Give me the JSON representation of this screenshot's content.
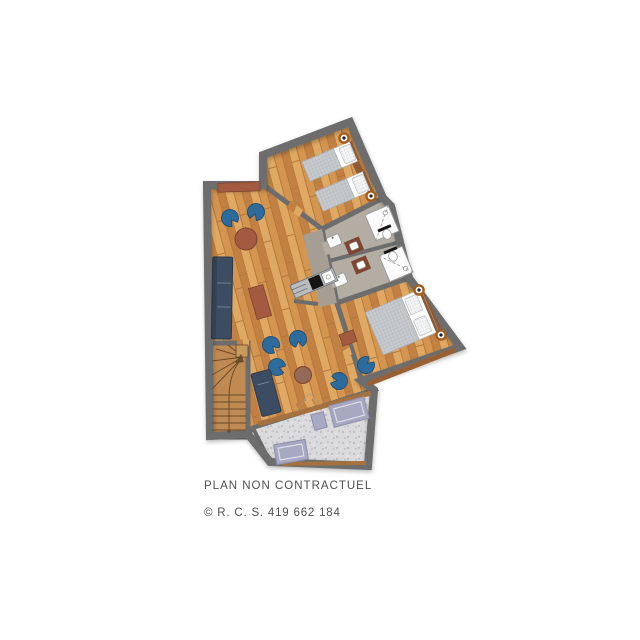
{
  "plan": {
    "caption": "PLAN NON CONTRACTUEL",
    "registration": "© R. C. S. 419 662 184"
  },
  "elements": {
    "rooms": [
      "living-dining-room",
      "twin-bedroom",
      "double-bedroom",
      "bathroom-1",
      "bathroom-2",
      "hallway",
      "kitchenette",
      "staircase",
      "terrace"
    ],
    "furniture": [
      {
        "name": "twin-bed",
        "count": 2
      },
      {
        "name": "double-bed",
        "count": 1
      },
      {
        "name": "wall-light",
        "count": 4
      },
      {
        "name": "shower",
        "count": 2
      },
      {
        "name": "toilet",
        "count": 2
      },
      {
        "name": "washbasin",
        "count": 2
      },
      {
        "name": "vanity-unit",
        "count": 2
      },
      {
        "name": "kitchen-unit",
        "count": 1
      },
      {
        "name": "sofa",
        "count": 1
      },
      {
        "name": "lounge-chair-blue",
        "count": 7
      },
      {
        "name": "chaise-longue",
        "count": 1
      },
      {
        "name": "round-table",
        "count": 2
      },
      {
        "name": "dining-table",
        "count": 1
      },
      {
        "name": "sideboard",
        "count": 1
      },
      {
        "name": "sun-lounger-mat",
        "count": 3
      },
      {
        "name": "winder-staircase",
        "count": 1
      }
    ]
  },
  "colors": {
    "background": "#ffffff",
    "wall": "#6d6d6d",
    "wood_light": "#e0a963",
    "wood_mid": "#d3954f",
    "wood_dark": "#c28143",
    "wood_line": "#b1753a",
    "tile": "#b4ada4",
    "tile_dark": "#a69e94",
    "white_fixture": "#fbfbfb",
    "fixture_line": "#9a9a9a",
    "bed_cover": "#c7cacd",
    "bed_grid": "#a6abb1",
    "pillow": "#f2f3f4",
    "headboard": "#8d5a35",
    "sill": "#9a6033",
    "terrace_floor": "#dadadc",
    "terrace_dot": "#9a9aa0",
    "terrace_band": "#a5713f",
    "mat": "#a7a8c2",
    "mat_line": "#8e8fad",
    "navy": "#3c4d63",
    "navy_dark": "#2c3a4d",
    "chair_blue": "#2e6b9d",
    "chair_blue_dark": "#1c4f78",
    "terracotta": "#a35a41",
    "terracotta_dark": "#7e4530",
    "taupe": "#946a57",
    "stair": "#c08b52",
    "stair_line": "#6a4a2a",
    "light_ring": "#a55d1f",
    "light_dot": "#1e1e1e",
    "kitchen_gray": "#b9bcc0",
    "kitchen_dark": "#151515",
    "caption": "#4f4f4f"
  }
}
